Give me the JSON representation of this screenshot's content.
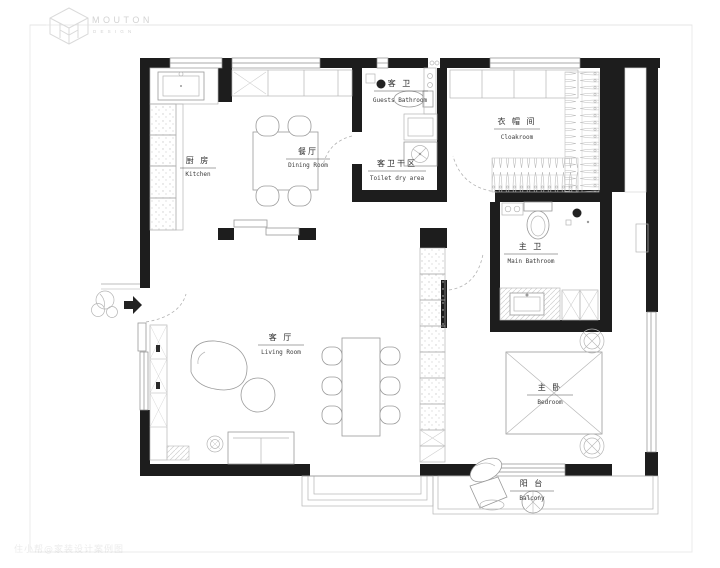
{
  "page": {
    "background": "#ffffff",
    "wall_color": "#1d1d1d",
    "frame_color": "#e8e8e8",
    "furniture_line_color": "#9a9a9a",
    "label_color": "#2e2e2e"
  },
  "logo": {
    "brand": "MOUTON",
    "subtitle": "DESIGN"
  },
  "watermark": {
    "text": "住小帮@家装设计案例图"
  },
  "rooms": {
    "kitchen": {
      "zh": "厨 房",
      "en": "Kitchen"
    },
    "dining": {
      "zh": "餐厅",
      "en": "Dining Room"
    },
    "guests_bathroom": {
      "zh": "客 卫",
      "en": "Guests Bathroom"
    },
    "toilet_dry_area": {
      "zh": "客卫干区",
      "en": "Toilet dry area"
    },
    "cloakroom": {
      "zh": "衣 帽 间",
      "en": "Cloakroom"
    },
    "main_bathroom": {
      "zh": "主 卫",
      "en": "Main Bathroom"
    },
    "living_room": {
      "zh": "客 厅",
      "en": "Living Room"
    },
    "bedroom": {
      "zh": "主 卧",
      "en": "Bedroom"
    },
    "balcony": {
      "zh": "阳 台",
      "en": "Balcony"
    }
  }
}
